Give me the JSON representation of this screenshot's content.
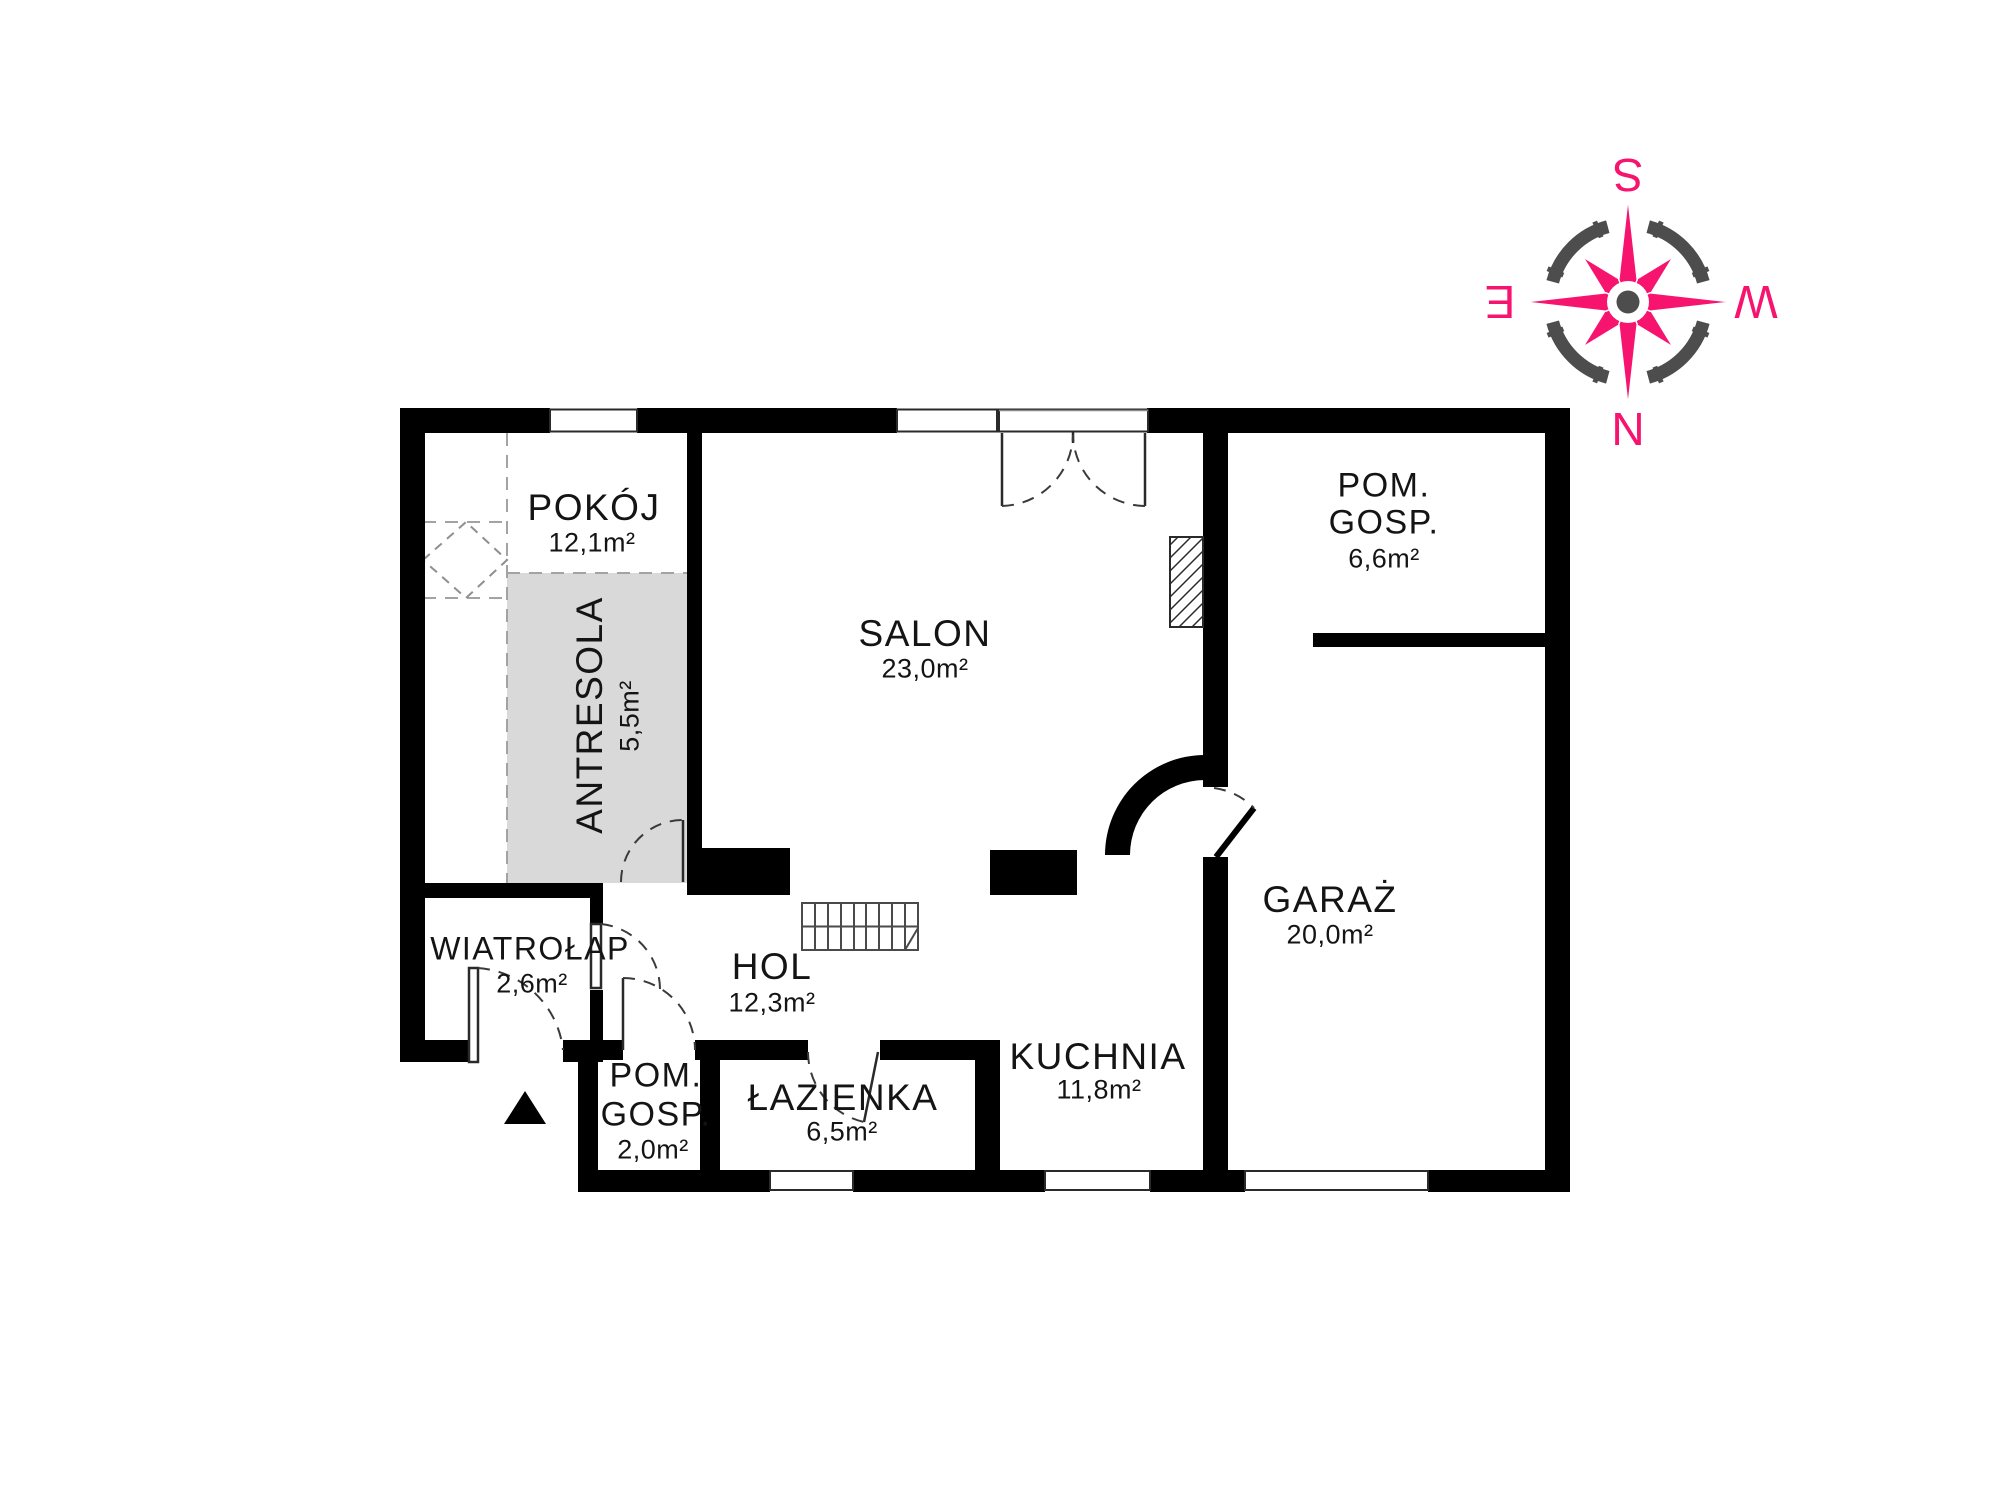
{
  "floor_plan": {
    "rooms": {
      "pokoj": {
        "label": "POKÓJ",
        "area": "12,1m²"
      },
      "antresola": {
        "label": "ANTRESOLA",
        "area": "5,5m²"
      },
      "salon": {
        "label": "SALON",
        "area": "23,0m²"
      },
      "pom_gosp_top": {
        "label_line1": "POM.",
        "label_line2": "GOSP.",
        "area": "6,6m²"
      },
      "garaz": {
        "label": "GARAŻ",
        "area": "20,0m²"
      },
      "kuchnia": {
        "label": "KUCHNIA",
        "area": "11,8m²"
      },
      "hol": {
        "label": "HOL",
        "area": "12,3m²"
      },
      "lazienka": {
        "label": "ŁAZIENKA",
        "area": "6,5m²"
      },
      "wiatrolap": {
        "label": "WIATROŁAP",
        "area": "2,6m²"
      },
      "pom_gosp_small": {
        "label_line1": "POM.",
        "label_line2": "GOSP.",
        "area": "2,0m²"
      }
    },
    "compass": {
      "north": "N",
      "south": "S",
      "east": "E",
      "west": "W",
      "orientation_note": "south-up"
    },
    "colors": {
      "wall": "#000000",
      "text": "#141414",
      "antresola_fill": "#d9d9d9",
      "compass_pink": "#f6146e",
      "compass_gray": "#4d4d4d"
    }
  }
}
